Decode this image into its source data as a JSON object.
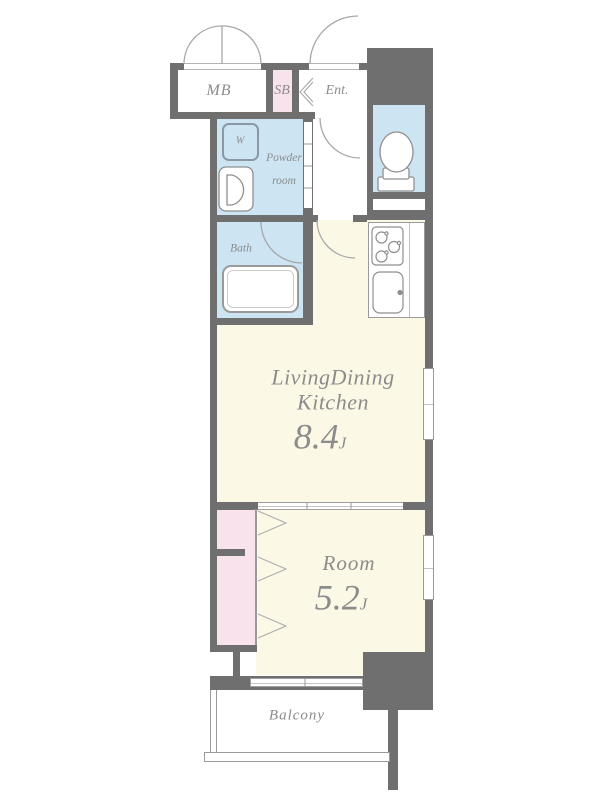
{
  "colors": {
    "bg": "#ffffff",
    "wall": "#6f6f6f",
    "cream": "#fbf8e6",
    "wet": "#cde4f2",
    "pink": "#f8e3ec",
    "line": "#9a9a9a",
    "text": "#8c8c8c"
  },
  "rooms": {
    "meter_box": {
      "label": "MB"
    },
    "shoe_box": {
      "label": "SB"
    },
    "entrance": {
      "label": "Ent."
    },
    "washer": {
      "label": "W"
    },
    "powder_room": {
      "label_line1": "Powder",
      "label_line2": "room"
    },
    "bath": {
      "label": "Bath"
    },
    "ldk": {
      "label_line1": "LivingDining",
      "label_line2": "Kitchen",
      "size_value": "8.4",
      "size_unit": "J"
    },
    "bedroom": {
      "label": "Room",
      "size_value": "5.2",
      "size_unit": "J"
    },
    "balcony": {
      "label": "Balcony"
    }
  }
}
